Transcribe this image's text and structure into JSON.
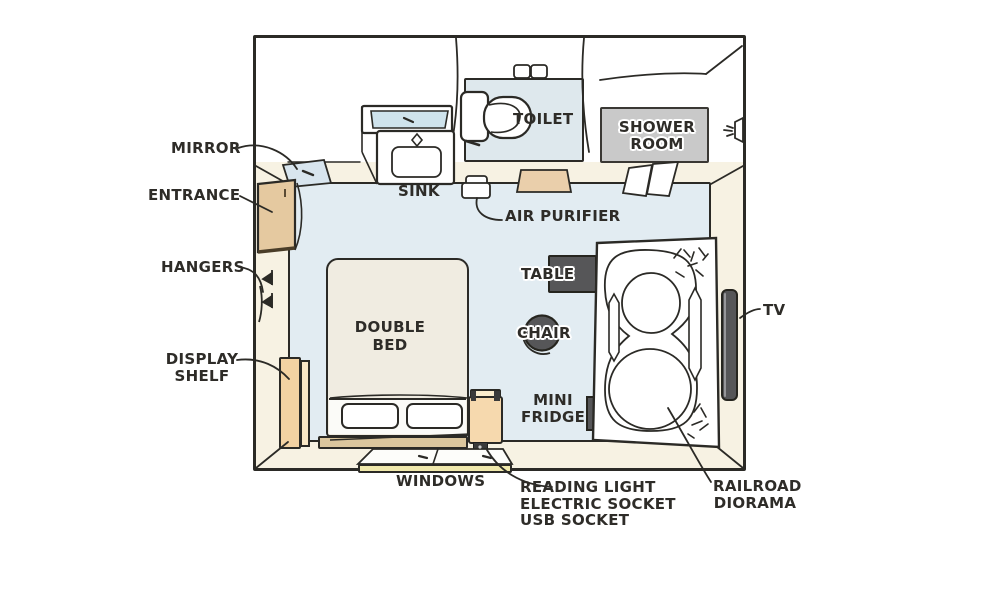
{
  "diagram": {
    "type": "hotel-room-floor-plan",
    "labels": {
      "mirror": "MIRROR",
      "entrance": "ENTRANCE",
      "hangers": "HANGERS",
      "display_shelf_line1": "DISPLAY",
      "display_shelf_line2": "SHELF",
      "sink": "SINK",
      "toilet": "TOILET",
      "shower_room_line1": "SHOWER",
      "shower_room_line2": "ROOM",
      "air_purifier": "AIR PURIFIER",
      "table": "TABLE",
      "chair": "CHAIR",
      "double_bed_line1": "DOUBLE",
      "double_bed_line2": "BED",
      "mini_fridge_line1": "MINI",
      "mini_fridge_line2": "FRIDGE",
      "tv": "TV",
      "windows": "WINDOWS",
      "bedside_features_line1": "READING LIGHT",
      "bedside_features_line2": "ELECTRIC SOCKET",
      "bedside_features_line3": "USB SOCKET",
      "railroad_diorama_line1": "RAILROAD",
      "railroad_diorama_line2": "DIORAMA"
    },
    "colors": {
      "background": "#ffffff",
      "wall": "#f7f2e3",
      "main_floor": "#e2ecf2",
      "bath_floor": "#dee8ed",
      "shower_floor": "#c9c9c9",
      "wood": "#e5c9a0",
      "window_frame": "#f0e9ac",
      "dark_furniture": "#565658",
      "bed": "#f0ece1",
      "outline": "#2b2a26"
    }
  }
}
